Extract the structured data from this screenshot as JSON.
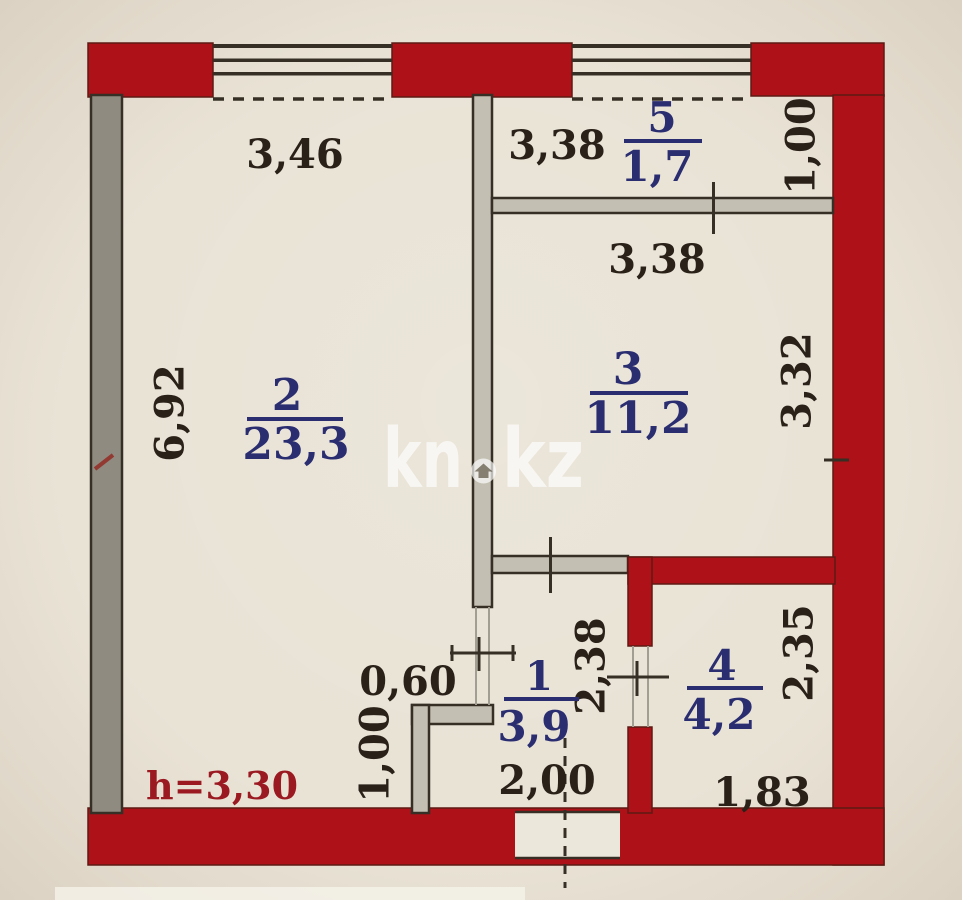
{
  "plan_title": "apartment-floor-plan",
  "colors": {
    "wall_red": "#ae1118",
    "wall_red_edge": "#5d1a14",
    "wall_gray": "#8f8b81",
    "wall_light": "#c3bfb2",
    "line_dark": "#362f25",
    "jamb_gray": "#a39e92",
    "text_black": "#2a2119",
    "text_blue": "#2b2d71",
    "text_dark_red": "#9b1a22",
    "paper": "#e9e3d6",
    "paper_light": "#ece7db",
    "watermark": "#ffffff"
  },
  "rooms": {
    "r1": {
      "number": "1",
      "area": "3,9"
    },
    "r2": {
      "number": "2",
      "area": "23,3"
    },
    "r3": {
      "number": "3",
      "area": "11,2"
    },
    "r4": {
      "number": "4",
      "area": "4,2"
    },
    "r5": {
      "number": "5",
      "area": "1,7"
    }
  },
  "dims": {
    "room2_width": "3,46",
    "room5_width": "3,38",
    "room5_depth": "1,00",
    "room3_width": "3,38",
    "room3_depth": "3,32",
    "room2_depth": "6,92",
    "niche_width": "0,60",
    "hall_depth": "2,38",
    "hall_width": "2,00",
    "niche_depth": "1,00",
    "room4_depth": "2,35",
    "room4_width": "1,83",
    "ceiling_height": "h=3,30"
  },
  "watermark": {
    "left": "kn",
    "right": "kz",
    "dot_icon": "house"
  }
}
